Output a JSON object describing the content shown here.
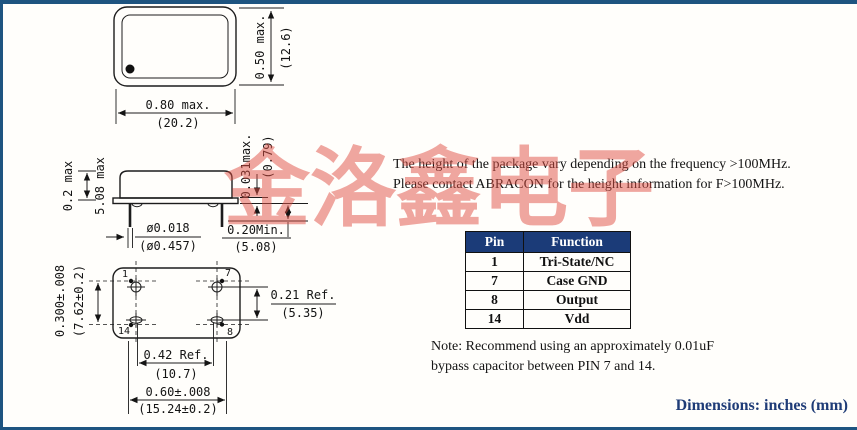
{
  "frame": {
    "accent_color": "#1e5480"
  },
  "watermark": {
    "text": "金洛鑫电子",
    "color": "#e05045"
  },
  "top_view": {
    "width_in": "0.80 max.",
    "width_mm": "(20.2)",
    "height_in": "0.50 max.",
    "height_mm": "(12.6)"
  },
  "side_view": {
    "body_height_in": "0.2 max",
    "body_height_mm": "5.08 max",
    "seat_thickness_in": "0.031max.",
    "seat_thickness_mm": "(0.79)",
    "lead_dia_in": "ø0.018",
    "lead_dia_mm": "(ø0.457)",
    "lead_len_in": "0.20Min.",
    "lead_len_mm": "(5.08)"
  },
  "bottom_view": {
    "pin_labels": {
      "p1": "1",
      "p7": "7",
      "p14": "14",
      "p8": "8"
    },
    "row_pitch_in": "0.300±.008",
    "row_pitch_mm": "(7.62±0.2)",
    "ref_in": "0.21 Ref.",
    "ref_mm": "(5.35)",
    "col_pitch_in": "0.42 Ref.",
    "col_pitch_mm": "(10.7)",
    "width_in": "0.60±.008",
    "width_mm": "(15.24±0.2)"
  },
  "callout": {
    "line1": "The height of the package vary depending on the frequency >100MHz.",
    "line2": "Please contact ABRACON for the height information for F>100MHz."
  },
  "pin_table": {
    "header_bg": "#1b3b78",
    "headers": [
      "Pin",
      "Function"
    ],
    "rows": [
      [
        "1",
        "Tri-State/NC"
      ],
      [
        "7",
        "Case GND"
      ],
      [
        "8",
        "Output"
      ],
      [
        "14",
        "Vdd"
      ]
    ]
  },
  "note": {
    "line1": "Note: Recommend using an approximately 0.01uF",
    "line2": "bypass capacitor between PIN 7 and 14."
  },
  "footer": {
    "dimensions_label": "Dimensions: inches (mm)",
    "color": "#1f3c77"
  }
}
